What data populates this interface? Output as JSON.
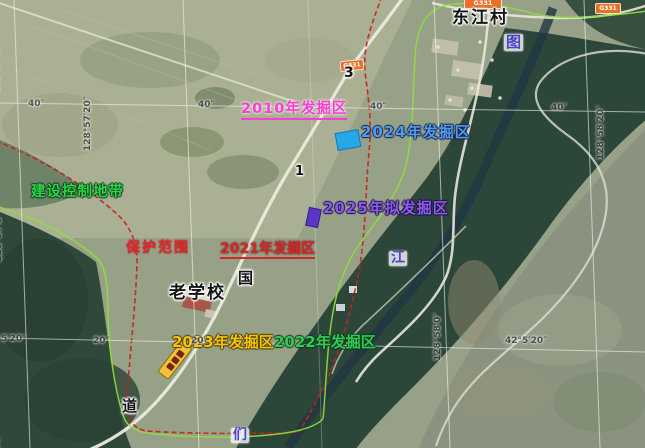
{
  "labels": {
    "village": "东江村",
    "old_school": "老学校",
    "protection_zone": "保护范围",
    "construction_control_zone": "建设控制地带",
    "excavation_2010": "2010年发掘区",
    "excavation_2021": "2021年发掘区",
    "excavation_2022": "2022年发掘区",
    "excavation_2023": "2023年发掘区",
    "excavation_2024": "2024年发掘区",
    "excavation_2025": "2025年拟发掘区",
    "river_char_tu": "图",
    "river_char_jiang": "江",
    "river_char_men": "们",
    "road_char_guo": "国",
    "road_char_dao": "道",
    "road_marker_3": "3",
    "road_marker_1": "1",
    "road_badge": "G331"
  },
  "grid": {
    "t40": "40″",
    "t20": "20″",
    "t520": "5′20″",
    "t42520": "42°5′20″",
    "t50": "50″",
    "lon570": "128°57′0″",
    "lon5720": "128°57′20″",
    "lon580": "128°58′0″",
    "lon5820": "128°58′20″"
  },
  "colors": {
    "area_2024_marker": "#28a7e8",
    "area_2025_marker": "#5a36c8",
    "protection_boundary": "#c92020",
    "construction_boundary": "#8ce03c",
    "excavation_2010_text": "#f541cc",
    "excavation_2024_text": "#4f9bec",
    "excavation_2025_text": "#8a5ce8",
    "road_badge_bg": "#e8702a",
    "county_badge_bg": "#f0c23c"
  }
}
